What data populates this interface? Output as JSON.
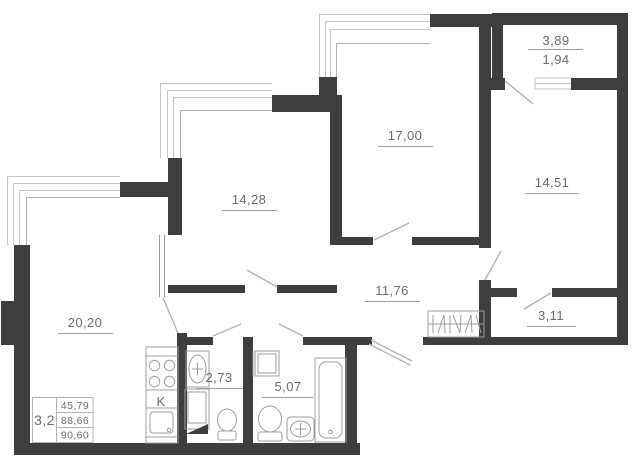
{
  "plan": {
    "type": "apartment-floor-plan",
    "labels": {
      "balcony_upper": "3,89",
      "balcony_lower": "1,94",
      "room_17": "17,00",
      "room_1451": "14,51",
      "room_1428": "14,28",
      "room_2020": "20,20",
      "hallway": "11,76",
      "room_311": "3,11",
      "bath_273": "2,73",
      "bath_507": "5,07",
      "kitchen": "K"
    },
    "summary_table": {
      "apartment_type": "3,2",
      "rows": [
        "45,79",
        "88,66",
        "90,60"
      ]
    },
    "colors": {
      "wall": "#3e3e3e",
      "window_line": "#c6c6c6",
      "fixture_line": "#9c9c9c",
      "door_line": "#b2b2b2",
      "text": "#6b6b6b"
    }
  }
}
